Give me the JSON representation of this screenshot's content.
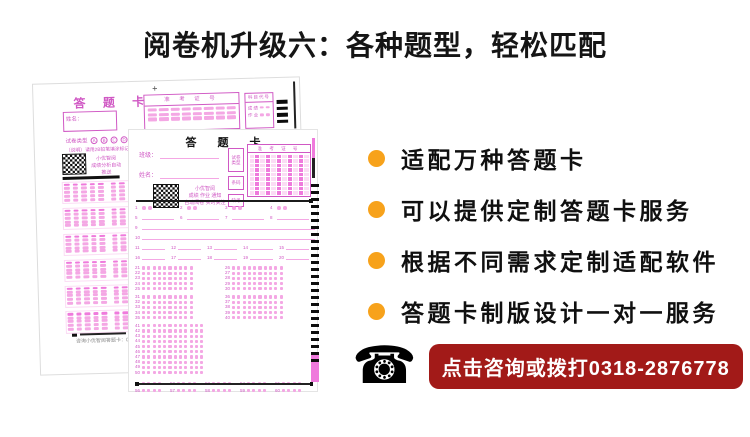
{
  "title": "阅卷机升级六：各种题型，轻松匹配",
  "bullets": [
    {
      "label": "适配万种答题卡"
    },
    {
      "label": "可以提供定制答题卡服务"
    },
    {
      "label": "根据不同需求定制适配软件"
    },
    {
      "label": "答题卡制版设计一对一服务"
    }
  ],
  "contact": {
    "phone_icon": "☎",
    "label": "点击咨询或拨打0318-2876778"
  },
  "back_sheet": {
    "plus_mark": "+",
    "title": "答 题 卡",
    "exam_no_header": "准 考 证 号",
    "subject_code_header": "科目代号",
    "subject_rows": [
      "成 绩",
      "作 业"
    ],
    "name_label": "姓名：",
    "paper_type_label": "试卷类型",
    "paper_type_options": [
      "A",
      "B",
      "C",
      "D"
    ],
    "instruction": "（说明）请用2B铅笔填涂标记 ■",
    "qr_caption": [
      "小优智阅",
      "成绩分析自动推送"
    ],
    "footer": "咨询小优智阅答题卡：0318-28"
  },
  "front_sheet": {
    "title": "答 题 卡",
    "class_label": "班级：",
    "name_label": "姓名：",
    "paper_type_label": "试卷类型",
    "barcode_label": "条码",
    "absent_label": "缺考",
    "exam_no_header": "准 考 证 号",
    "qr_caption": [
      "小优智阅",
      "成绩 作业 通知",
      "自动阅卷 实时关注"
    ],
    "question_rows": [
      {
        "type": "tf",
        "start": 1,
        "count": 4
      },
      {
        "type": "blank",
        "start": 5,
        "count": 4
      },
      {
        "type": "line",
        "start": 9
      },
      {
        "type": "line",
        "start": 10
      },
      {
        "type": "blank",
        "start": 11,
        "count": 5
      },
      {
        "type": "blank",
        "start": 16,
        "count": 5
      },
      {
        "type": "bubbles2col",
        "start": 21,
        "rows": 5
      },
      {
        "type": "bubbles2col",
        "start": 31,
        "rows": 5
      },
      {
        "type": "bubbles1col",
        "start": 41,
        "rows": 10
      },
      {
        "type": "groups",
        "start": 51,
        "count": 10
      }
    ]
  },
  "colors": {
    "bullet": "#F7A21B",
    "contact_bg": "#A21A18",
    "sheet_accent": "#D058C4",
    "pink_light": "#FBDCF4",
    "pink_mid": "#F4A7E4",
    "pink_strong": "#EF7ADC"
  }
}
